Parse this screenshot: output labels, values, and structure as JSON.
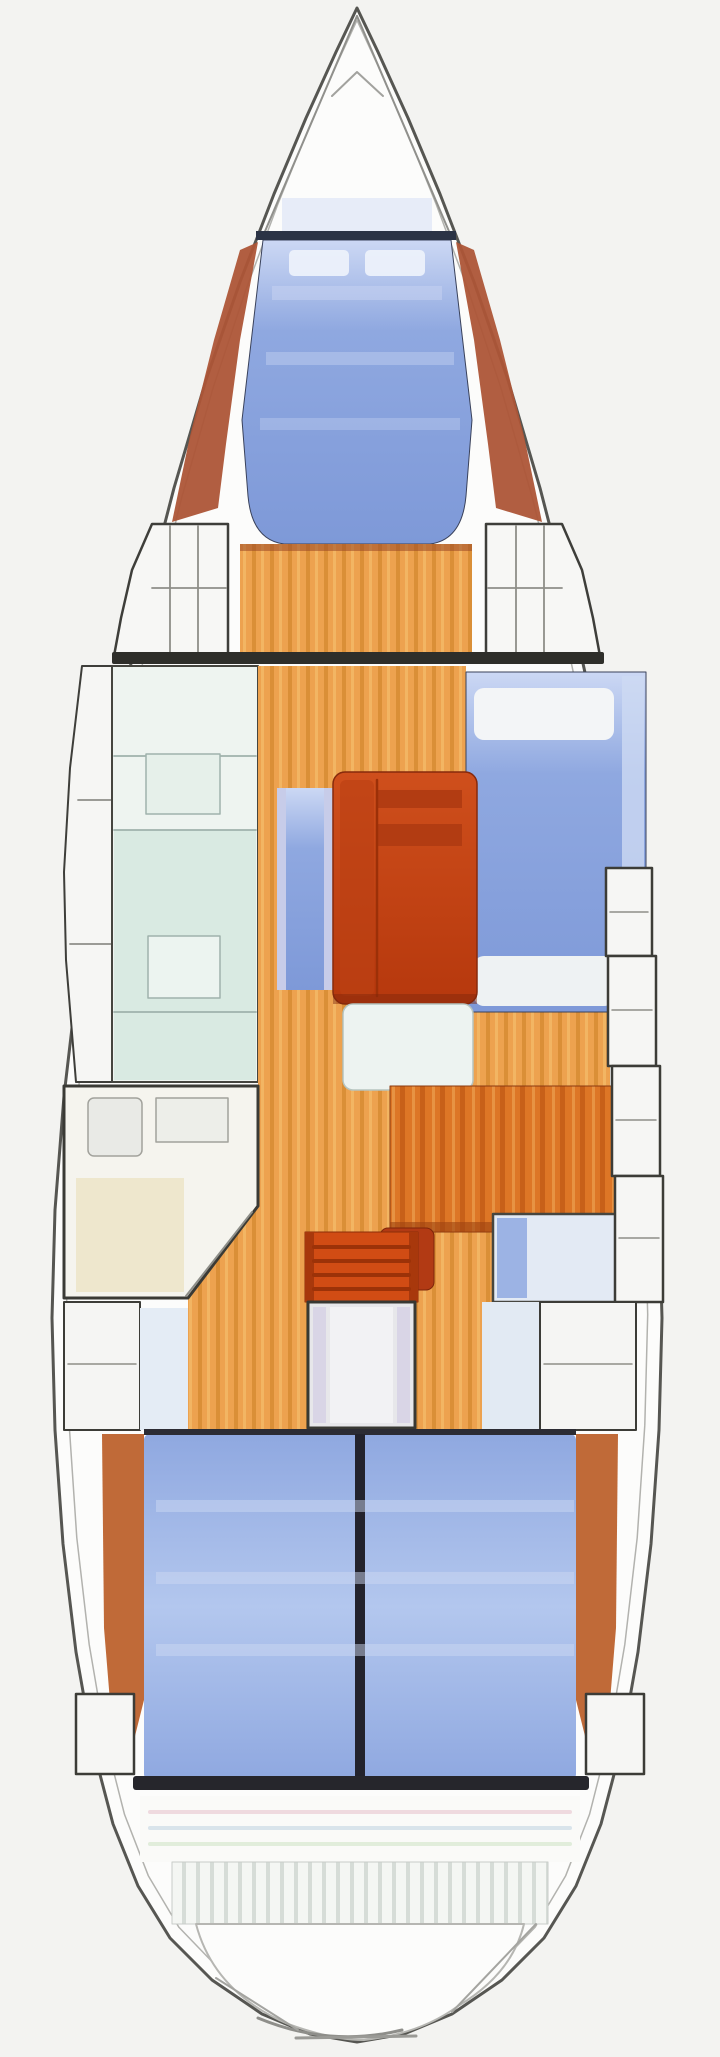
{
  "diagram": {
    "kind": "sailboat-interior-floorplan",
    "orientation": "bow-up"
  },
  "canvas": {
    "width": 720,
    "height": 2057,
    "background": "#f3f3f1"
  },
  "palette": {
    "hull_fill": "#fcfcfb",
    "outline": "#565652",
    "inner_line": "#b2b2ae",
    "line_gray": "#8e8e88",
    "dark": "#2e2e2a",
    "navy": "#2b3345",
    "berth_light": "#ccd8f4",
    "berth_mid": "#8fa8e0",
    "berth_deep": "#7e99d8",
    "berth_aft_mid": "#b3c7ee",
    "table_light": "#cf4f1c",
    "table_deep": "#b6380d",
    "wood": "#eda24f",
    "wood_dark": "#d2882c",
    "wood_light": "#f4ba68",
    "desk": "#dd7626",
    "desk_dark": "#c05814",
    "desk_light": "#ea9a4a",
    "trim": "#ad5537",
    "teal": "#d9eae2",
    "cream": "#eee7cd",
    "platform": "#f4f6f3",
    "platform_stripe": "#d6dcd7",
    "steps_red": "#d14c14",
    "seat_red": "#b23a14"
  },
  "hull": {
    "points": "357,8 336,52 306,118 274,194 240,282 206,380 174,488 145,600 119,718 97,840 79,968 64,1096 55,1210 52,1318 55,1430 63,1544 76,1652 93,1748 113,1824 138,1886 170,1938 212,1980 262,2014 310,2034 357,2042 404,2034 452,2014 502,1980 544,1938 576,1886 601,1824 621,1748 638,1652 651,1544 659,1430 662,1318 659,1210 650,1096 635,968 617,840 595,718 569,600 540,488 508,380 474,282 440,194 408,118 378,52",
    "inner_scale_x": 0.953,
    "inner_scale_y": 0.988,
    "cx": 357,
    "cy": 1026
  },
  "shapes": [
    {
      "n": "hull-outline",
      "k": "poly",
      "pts": "HULL",
      "f": "#fcfcfb",
      "s": "#565652",
      "sw": 3
    },
    {
      "n": "deck-inner-line",
      "k": "innerpoly",
      "f": "none",
      "s": "#b2b2ae",
      "sw": 1.5
    },
    {
      "n": "bow-pulpit-line-left",
      "k": "line",
      "x1": 357,
      "y1": 16,
      "x2": 263,
      "y2": 236,
      "s": "#90908c",
      "sw": 2
    },
    {
      "n": "bow-pulpit-line-right",
      "k": "line",
      "x1": 357,
      "y1": 16,
      "x2": 451,
      "y2": 236,
      "s": "#90908c",
      "sw": 2
    },
    {
      "n": "anchor-locker-hatch",
      "k": "pline",
      "pts": "332,96 357,72 383,96",
      "s": "#a2a29e",
      "sw": 2
    },
    {
      "n": "fwd-berth-trim-port",
      "k": "poly",
      "pts": "258,242 240,340 226,444 218,508 172,522 190,436 214,340 240,250",
      "f": "#ad5537",
      "o": 0.95
    },
    {
      "n": "fwd-berth-trim-stbd",
      "k": "poly",
      "pts": "456,242 474,340 488,444 496,508 542,522 524,436 500,340 474,250",
      "f": "#ad5537",
      "o": 0.95
    },
    {
      "n": "fwd-berth-head-glow",
      "k": "rect",
      "x": 282,
      "y": 198,
      "w": 150,
      "h": 34,
      "f": "#e3e9f7",
      "o": 0.85
    },
    {
      "n": "fwd-vberth",
      "k": "path",
      "d": "M263,240 L451,240 L472,420 L466,496 Q462,540 430,544 L284,544 Q252,540 248,496 L242,420 Z",
      "f": "url(#gBerthF)",
      "s": "#39415a",
      "sw": 1
    },
    {
      "n": "fwd-berth-head-line",
      "k": "rect",
      "x": 256,
      "y": 231,
      "w": 200,
      "h": 9,
      "f": "#2b3345"
    },
    {
      "n": "fwd-berth-pillow-port",
      "k": "rect",
      "x": 289,
      "y": 250,
      "w": 60,
      "h": 26,
      "rx": 5,
      "f": "#eef2fb",
      "o": 0.92
    },
    {
      "n": "fwd-berth-pillow-stbd",
      "k": "rect",
      "x": 365,
      "y": 250,
      "w": 60,
      "h": 26,
      "rx": 5,
      "f": "#eef2fb",
      "o": 0.92
    },
    {
      "n": "fwd-berth-panel-band-1",
      "k": "rect",
      "x": 272,
      "y": 286,
      "w": 170,
      "h": 14,
      "f": "#c6d2f1",
      "o": 0.55
    },
    {
      "n": "fwd-berth-panel-band-2",
      "k": "rect",
      "x": 266,
      "y": 352,
      "w": 188,
      "h": 13,
      "f": "#c6d2f1",
      "o": 0.45
    },
    {
      "n": "fwd-berth-panel-band-3",
      "k": "rect",
      "x": 260,
      "y": 418,
      "w": 200,
      "h": 12,
      "f": "#c6d2f1",
      "o": 0.38
    },
    {
      "n": "fwd-cabin-floor",
      "k": "rect",
      "x": 240,
      "y": 544,
      "w": 232,
      "h": 112,
      "f": "url(#plank)"
    },
    {
      "n": "fwd-berth-front-edge",
      "k": "rect",
      "x": 240,
      "y": 544,
      "w": 232,
      "h": 7,
      "f": "#9a4826",
      "o": 0.55
    },
    {
      "n": "fwd-locker-port",
      "k": "poly",
      "pts": "228,524 152,524 132,570 121,618 114,656 228,656",
      "f": "#f7f7f5",
      "s": "#3e3e3a",
      "sw": 2.5
    },
    {
      "n": "fwd-locker-stbd",
      "k": "poly",
      "pts": "486,524 562,524 582,570 593,618 600,656 486,656",
      "f": "#f7f7f5",
      "s": "#3e3e3a",
      "sw": 2.5
    },
    {
      "n": "fwd-locker-port-shelf-line",
      "k": "line",
      "x1": 152,
      "y1": 588,
      "x2": 226,
      "y2": 588,
      "s": "#8e8e88",
      "sw": 1.8
    },
    {
      "n": "fwd-locker-port-div-1",
      "k": "line",
      "x1": 170,
      "y1": 526,
      "x2": 170,
      "y2": 654,
      "s": "#8e8e88",
      "sw": 1.8
    },
    {
      "n": "fwd-locker-port-div-2",
      "k": "line",
      "x1": 198,
      "y1": 526,
      "x2": 198,
      "y2": 654,
      "s": "#8e8e88",
      "sw": 1.8
    },
    {
      "n": "fwd-locker-stbd-shelf-line",
      "k": "line",
      "x1": 488,
      "y1": 588,
      "x2": 562,
      "y2": 588,
      "s": "#8e8e88",
      "sw": 1.8
    },
    {
      "n": "fwd-locker-stbd-div-1",
      "k": "line",
      "x1": 516,
      "y1": 526,
      "x2": 516,
      "y2": 654,
      "s": "#8e8e88",
      "sw": 1.8
    },
    {
      "n": "fwd-locker-stbd-div-2",
      "k": "line",
      "x1": 544,
      "y1": 526,
      "x2": 544,
      "y2": 654,
      "s": "#8e8e88",
      "sw": 1.8
    },
    {
      "n": "main-bulkhead",
      "k": "rect",
      "x": 112,
      "y": 652,
      "w": 492,
      "h": 12,
      "rx": 2,
      "f": "#2e2e2a"
    },
    {
      "n": "port-hull-lockers",
      "k": "poly",
      "pts": "112,666 112,1082 76,1082 66,960 64,872 70,768 82,666",
      "f": "#f6f6f4",
      "s": "#3e3e3a",
      "sw": 2
    },
    {
      "n": "port-hull-locker-div-1",
      "k": "line",
      "x1": 78,
      "y1": 800,
      "x2": 112,
      "y2": 800,
      "s": "#8e8e88",
      "sw": 1.8
    },
    {
      "n": "port-hull-locker-div-2",
      "k": "line",
      "x1": 70,
      "y1": 944,
      "x2": 112,
      "y2": 944,
      "s": "#8e8e88",
      "sw": 1.8
    },
    {
      "n": "galley-block",
      "k": "rect",
      "x": 112,
      "y": 666,
      "w": 146,
      "h": 416,
      "f": "#eef4f0",
      "s": "#45453f",
      "sw": 2
    },
    {
      "n": "galley-counter",
      "k": "rect",
      "x": 114,
      "y": 830,
      "w": 142,
      "h": 250,
      "f": "#d9eae2"
    },
    {
      "n": "galley-line-1",
      "k": "line",
      "x1": 114,
      "y1": 756,
      "x2": 256,
      "y2": 756,
      "s": "#9fb2ac",
      "sw": 1.8
    },
    {
      "n": "galley-line-2",
      "k": "line",
      "x1": 114,
      "y1": 830,
      "x2": 256,
      "y2": 830,
      "s": "#9fb2ac",
      "sw": 1.8
    },
    {
      "n": "galley-line-3",
      "k": "line",
      "x1": 114,
      "y1": 1012,
      "x2": 256,
      "y2": 1012,
      "s": "#9fb2ac",
      "sw": 1.8
    },
    {
      "n": "galley-stove",
      "k": "rect",
      "x": 146,
      "y": 754,
      "w": 74,
      "h": 60,
      "f": "#e6f0ea",
      "s": "#9fb2ac",
      "sw": 1.5
    },
    {
      "n": "galley-sink",
      "k": "rect",
      "x": 148,
      "y": 936,
      "w": 72,
      "h": 62,
      "f": "#ecf4f0",
      "s": "#9fb2ac",
      "sw": 1.5
    },
    {
      "n": "cabin-sole-floor",
      "k": "poly",
      "pts": "258,666 466,666 466,1012 610,1012 610,1302 482,1302 482,1430 188,1430 188,1298 258,1206",
      "f": "url(#plank)"
    },
    {
      "n": "head-compartment",
      "k": "poly",
      "pts": "64,1086 258,1086 258,1206 188,1298 64,1298",
      "f": "#f5f4ee",
      "s": "#3a3a35",
      "sw": 3
    },
    {
      "n": "head-floor-panel",
      "k": "rect",
      "x": 76,
      "y": 1178,
      "w": 108,
      "h": 114,
      "f": "#eee7cd"
    },
    {
      "n": "head-toilet",
      "k": "rect",
      "x": 88,
      "y": 1098,
      "w": 54,
      "h": 58,
      "rx": 6,
      "f": "#e9eae6",
      "s": "#a2a29c",
      "sw": 1.5
    },
    {
      "n": "head-sink",
      "k": "rect",
      "x": 156,
      "y": 1098,
      "w": 72,
      "h": 44,
      "f": "#edeee9",
      "s": "#a2a29c",
      "sw": 1.5
    },
    {
      "n": "head-door-line",
      "k": "line",
      "x1": 252,
      "y1": 1212,
      "x2": 186,
      "y2": 1296,
      "s": "#8e8e88",
      "sw": 2
    },
    {
      "n": "stbd-settee",
      "k": "rect",
      "x": 466,
      "y": 672,
      "w": 180,
      "h": 340,
      "f": "url(#gBerthF)",
      "s": "#39415a",
      "sw": 1
    },
    {
      "n": "stbd-settee-backrest",
      "k": "rect",
      "x": 622,
      "y": 676,
      "w": 22,
      "h": 332,
      "f": "#cdd9f2",
      "o": 0.8
    },
    {
      "n": "stbd-settee-cushion-fwd",
      "k": "rect",
      "x": 474,
      "y": 688,
      "w": 140,
      "h": 52,
      "rx": 10,
      "f": "#f3f5f7"
    },
    {
      "n": "stbd-settee-cushion-aft",
      "k": "rect",
      "x": 474,
      "y": 956,
      "w": 140,
      "h": 50,
      "rx": 10,
      "f": "#eef2f3"
    },
    {
      "n": "port-bench",
      "k": "rect",
      "x": 277,
      "y": 788,
      "w": 56,
      "h": 202,
      "f": "url(#gBerthF)"
    },
    {
      "n": "port-bench-edge-l",
      "k": "rect",
      "x": 277,
      "y": 788,
      "w": 9,
      "h": 202,
      "f": "#c7cce9"
    },
    {
      "n": "port-bench-edge-r",
      "k": "rect",
      "x": 324,
      "y": 788,
      "w": 9,
      "h": 202,
      "f": "#c7cce9"
    },
    {
      "n": "salon-table",
      "k": "rect",
      "x": 333,
      "y": 772,
      "w": 144,
      "h": 232,
      "rx": 12,
      "f": "url(#gTable)",
      "s": "#872a0c",
      "sw": 1.5
    },
    {
      "n": "salon-table-left-leaf",
      "k": "rect",
      "x": 340,
      "y": 780,
      "w": 34,
      "h": 216,
      "rx": 6,
      "f": "#bc4014",
      "o": 0.65
    },
    {
      "n": "salon-table-bar-1",
      "k": "rect",
      "x": 378,
      "y": 790,
      "w": 84,
      "h": 18,
      "f": "#b23c12"
    },
    {
      "n": "salon-table-bar-2",
      "k": "rect",
      "x": 378,
      "y": 824,
      "w": 84,
      "h": 22,
      "f": "#b23c12"
    },
    {
      "n": "salon-table-leaf-line",
      "k": "line",
      "x1": 377,
      "y1": 780,
      "x2": 377,
      "y2": 996,
      "s": "#9c3008",
      "sw": 2.5
    },
    {
      "n": "salon-table-shadow",
      "k": "rect",
      "x": 333,
      "y": 994,
      "w": 144,
      "h": 10,
      "f": "#7e260a",
      "o": 0.45
    },
    {
      "n": "aft-salon-seat",
      "k": "rect",
      "x": 343,
      "y": 1004,
      "w": 130,
      "h": 86,
      "rx": 10,
      "f": "#edf3f1",
      "s": "#b6c4bf",
      "sw": 1.5
    },
    {
      "n": "nav-station-desk",
      "k": "rect",
      "x": 390,
      "y": 1086,
      "w": 238,
      "h": 146,
      "f": "url(#plankRed)",
      "s": "#8c3a10",
      "sw": 1
    },
    {
      "n": "nav-desk-edge",
      "k": "rect",
      "x": 390,
      "y": 1222,
      "w": 238,
      "h": 10,
      "f": "#9c4210",
      "o": 0.6
    },
    {
      "n": "quarter-berth-panel",
      "k": "rect",
      "x": 493,
      "y": 1214,
      "w": 140,
      "h": 88,
      "f": "#e3eaf4",
      "s": "#464640",
      "sw": 2.5
    },
    {
      "n": "quarter-berth-blue-strip",
      "k": "rect",
      "x": 497,
      "y": 1218,
      "w": 30,
      "h": 80,
      "f": "#9cb3e4"
    },
    {
      "n": "nav-seat",
      "k": "rect",
      "x": 380,
      "y": 1228,
      "w": 54,
      "h": 62,
      "rx": 8,
      "f": "#b23a14",
      "s": "#7e260a",
      "sw": 1
    },
    {
      "n": "stbd-shelf-1",
      "k": "rect",
      "x": 606,
      "y": 868,
      "w": 46,
      "h": 88,
      "f": "#f6f6f4",
      "s": "#3c3c37",
      "sw": 2.5
    },
    {
      "n": "stbd-shelf-2",
      "k": "rect",
      "x": 608,
      "y": 956,
      "w": 48,
      "h": 110,
      "f": "#f6f6f4",
      "s": "#3c3c37",
      "sw": 2.5
    },
    {
      "n": "stbd-shelf-3",
      "k": "rect",
      "x": 612,
      "y": 1066,
      "w": 48,
      "h": 110,
      "f": "#f6f6f4",
      "s": "#3c3c37",
      "sw": 2.5
    },
    {
      "n": "stbd-shelf-4",
      "k": "rect",
      "x": 615,
      "y": 1176,
      "w": 48,
      "h": 126,
      "f": "#f6f6f4",
      "s": "#3c3c37",
      "sw": 2.5
    },
    {
      "n": "stbd-shelf-1-line",
      "k": "line",
      "x1": 610,
      "y1": 912,
      "x2": 648,
      "y2": 912,
      "s": "#8e8e88",
      "sw": 1.5
    },
    {
      "n": "stbd-shelf-2-line",
      "k": "line",
      "x1": 612,
      "y1": 1010,
      "x2": 652,
      "y2": 1010,
      "s": "#8e8e88",
      "sw": 1.5
    },
    {
      "n": "stbd-shelf-3-line",
      "k": "line",
      "x1": 616,
      "y1": 1120,
      "x2": 656,
      "y2": 1120,
      "s": "#8e8e88",
      "sw": 1.5
    },
    {
      "n": "stbd-shelf-4-line",
      "k": "line",
      "x1": 619,
      "y1": 1238,
      "x2": 659,
      "y2": 1238,
      "s": "#8e8e88",
      "sw": 1.5
    },
    {
      "n": "companionway-steps",
      "k": "rect",
      "x": 305,
      "y": 1232,
      "w": 113,
      "h": 70,
      "f": "#d14c14",
      "s": "#8c2e08",
      "sw": 1
    },
    {
      "n": "steps-rail-l",
      "k": "rect",
      "x": 305,
      "y": 1232,
      "w": 9,
      "h": 70,
      "f": "#a8380c"
    },
    {
      "n": "steps-rail-r",
      "k": "rect",
      "x": 409,
      "y": 1232,
      "w": 9,
      "h": 70,
      "f": "#a8380c"
    },
    {
      "n": "step-line-1",
      "k": "line",
      "x1": 314,
      "y1": 1247,
      "x2": 409,
      "y2": 1247,
      "s": "#9c3208",
      "sw": 4
    },
    {
      "n": "step-line-2",
      "k": "line",
      "x1": 314,
      "y1": 1261,
      "x2": 409,
      "y2": 1261,
      "s": "#9c3208",
      "sw": 4
    },
    {
      "n": "step-line-3",
      "k": "line",
      "x1": 314,
      "y1": 1275,
      "x2": 409,
      "y2": 1275,
      "s": "#9c3208",
      "sw": 4
    },
    {
      "n": "step-line-4",
      "k": "line",
      "x1": 314,
      "y1": 1289,
      "x2": 409,
      "y2": 1289,
      "s": "#9c3208",
      "sw": 4
    },
    {
      "n": "engine-box",
      "k": "rect",
      "x": 308,
      "y": 1302,
      "w": 107,
      "h": 126,
      "f": "#e7e7ea",
      "s": "#383833",
      "sw": 3
    },
    {
      "n": "engine-box-strip-l",
      "k": "rect",
      "x": 313,
      "y": 1307,
      "w": 13,
      "h": 116,
      "f": "#d9d5e6"
    },
    {
      "n": "engine-box-strip-r",
      "k": "rect",
      "x": 397,
      "y": 1307,
      "w": 13,
      "h": 116,
      "f": "#d9d5e6"
    },
    {
      "n": "engine-box-center",
      "k": "rect",
      "x": 330,
      "y": 1307,
      "w": 63,
      "h": 116,
      "f": "#f2f2f4"
    },
    {
      "n": "quarter-berth-entry",
      "k": "rect",
      "x": 482,
      "y": 1302,
      "w": 58,
      "h": 128,
      "f": "#e2eaf3"
    },
    {
      "n": "aft-locker-stbd",
      "k": "rect",
      "x": 540,
      "y": 1302,
      "w": 96,
      "h": 128,
      "f": "#f5f5f3",
      "s": "#3c3c37",
      "sw": 2
    },
    {
      "n": "aft-locker-stbd-line",
      "k": "line",
      "x1": 544,
      "y1": 1364,
      "x2": 632,
      "y2": 1364,
      "s": "#8e8e88",
      "sw": 1.5
    },
    {
      "n": "aft-locker-port",
      "k": "rect",
      "x": 64,
      "y": 1302,
      "w": 76,
      "h": 128,
      "f": "#f5f5f3",
      "s": "#3c3c37",
      "sw": 2
    },
    {
      "n": "aft-locker-port-line",
      "k": "line",
      "x1": 68,
      "y1": 1364,
      "x2": 136,
      "y2": 1364,
      "s": "#8e8e88",
      "sw": 1.5
    },
    {
      "n": "aft-cabin-entry-strip",
      "k": "rect",
      "x": 140,
      "y": 1308,
      "w": 48,
      "h": 122,
      "f": "#e4ecf5"
    },
    {
      "n": "aft-berth-trim-port",
      "k": "poly",
      "pts": "102,1434 144,1434 144,1700 128,1764 112,1726 104,1628",
      "f": "#c06a38"
    },
    {
      "n": "aft-berth-trim-stbd",
      "k": "poly",
      "pts": "618,1434 576,1434 576,1700 592,1764 608,1726 616,1628",
      "f": "#c06a38"
    },
    {
      "n": "aft-double-berth",
      "k": "rect",
      "x": 144,
      "y": 1434,
      "w": 432,
      "h": 346,
      "rx": 6,
      "f": "url(#gBerthAft)"
    },
    {
      "n": "aft-berth-head-line",
      "k": "rect",
      "x": 144,
      "y": 1429,
      "w": 432,
      "h": 6,
      "f": "#2c2c34"
    },
    {
      "n": "aft-berth-divider",
      "k": "rect",
      "x": 355,
      "y": 1434,
      "w": 10,
      "h": 346,
      "f": "#23232d"
    },
    {
      "n": "aft-berth-band-1",
      "k": "rect",
      "x": 156,
      "y": 1500,
      "w": 418,
      "h": 12,
      "f": "#ccd8f2",
      "o": 0.5
    },
    {
      "n": "aft-berth-band-2",
      "k": "rect",
      "x": 156,
      "y": 1572,
      "w": 418,
      "h": 12,
      "f": "#ccd8f2",
      "o": 0.5
    },
    {
      "n": "aft-berth-band-3",
      "k": "rect",
      "x": 156,
      "y": 1644,
      "w": 418,
      "h": 12,
      "f": "#ccd8f2",
      "o": 0.5
    },
    {
      "n": "aft-berth-foot-line",
      "k": "rect",
      "x": 133,
      "y": 1776,
      "w": 456,
      "h": 14,
      "rx": 3,
      "f": "#26262c"
    },
    {
      "n": "stern-locker-port",
      "k": "rect",
      "x": 76,
      "y": 1694,
      "w": 58,
      "h": 80,
      "f": "#f6f6f4",
      "s": "#3c3c37",
      "sw": 2.5
    },
    {
      "n": "stern-locker-stbd",
      "k": "rect",
      "x": 586,
      "y": 1694,
      "w": 58,
      "h": 80,
      "f": "#f6f6f4",
      "s": "#3c3c37",
      "sw": 2.5
    },
    {
      "n": "transom-zone",
      "k": "rect",
      "x": 140,
      "y": 1796,
      "w": 440,
      "h": 66,
      "f": "#fafaf8"
    },
    {
      "n": "transom-stripe-1",
      "k": "line",
      "x1": 150,
      "y1": 1812,
      "x2": 570,
      "y2": 1812,
      "s": "#ecd4da",
      "sw": 4,
      "o": 0.85
    },
    {
      "n": "transom-stripe-2",
      "k": "line",
      "x1": 150,
      "y1": 1828,
      "x2": 570,
      "y2": 1828,
      "s": "#d2dfe9",
      "sw": 4,
      "o": 0.85
    },
    {
      "n": "transom-stripe-3",
      "k": "line",
      "x1": 150,
      "y1": 1844,
      "x2": 570,
      "y2": 1844,
      "s": "#dcead6",
      "sw": 4,
      "o": 0.85
    },
    {
      "n": "swim-platform-teak",
      "k": "rect",
      "x": 172,
      "y": 1862,
      "w": 376,
      "h": 62,
      "f": "url(#teak)",
      "s": "#c8ccc8",
      "sw": 1
    },
    {
      "n": "swim-platform",
      "k": "path",
      "d": "M196,1924 Q214,1992 288,2024 Q332,2040 364,2040 Q420,2034 458,2006 Q512,1974 524,1924 Z",
      "f": "#fcfcfb",
      "s": "#b6b6b2",
      "sw": 2
    },
    {
      "n": "swim-platform-edge",
      "k": "path",
      "d": "M258,2018 Q330,2048 402,2030",
      "f": "none",
      "s": "#8e8e8a",
      "sw": 3
    },
    {
      "n": "swim-platform-flat",
      "k": "line",
      "x1": 296,
      "y1": 2038,
      "x2": 416,
      "y2": 2036,
      "s": "#9a9a96",
      "sw": 3
    },
    {
      "n": "transom-diag-port",
      "k": "line",
      "x1": 216,
      "y1": 1978,
      "x2": 298,
      "y2": 2030,
      "s": "#a4a4a0",
      "sw": 2
    },
    {
      "n": "transom-diag-stbd",
      "k": "line",
      "x1": 536,
      "y1": 1924,
      "x2": 452,
      "y2": 2012,
      "s": "#a4a4a0",
      "sw": 2
    }
  ]
}
